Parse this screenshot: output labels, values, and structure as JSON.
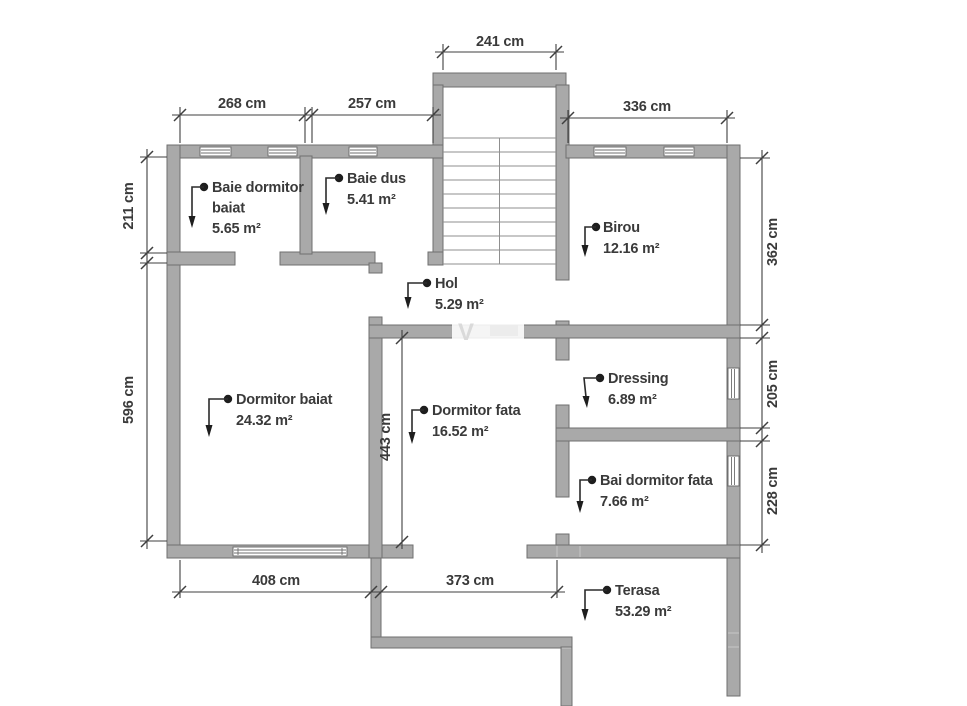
{
  "plan": {
    "watermark": "V",
    "rooms": [
      {
        "id": "baie-dormitor-baiat",
        "lines": [
          "Baie dormitor",
          "baiat",
          "5.65 m²"
        ]
      },
      {
        "id": "baie-dus",
        "lines": [
          "Baie dus",
          "5.41 m²"
        ]
      },
      {
        "id": "birou",
        "lines": [
          "Birou",
          "12.16 m²"
        ]
      },
      {
        "id": "hol",
        "lines": [
          "Hol",
          "5.29 m²"
        ]
      },
      {
        "id": "dormitor-baiat",
        "lines": [
          "Dormitor baiat",
          "24.32 m²"
        ]
      },
      {
        "id": "dormitor-fata",
        "lines": [
          "Dormitor fata",
          "16.52 m²"
        ]
      },
      {
        "id": "dressing",
        "lines": [
          "Dressing",
          "6.89 m²"
        ]
      },
      {
        "id": "bai-dormitor-fata",
        "lines": [
          "Bai dormitor fata",
          "7.66 m²"
        ]
      },
      {
        "id": "terasa",
        "lines": [
          "Terasa",
          "53.29 m²"
        ]
      }
    ],
    "dimensions": [
      {
        "id": "stairwell-width",
        "label": "241 cm"
      },
      {
        "id": "baie-dormitor-width",
        "label": "268 cm"
      },
      {
        "id": "baie-dus-width",
        "label": "257 cm"
      },
      {
        "id": "birou-width",
        "label": "336 cm"
      },
      {
        "id": "baie-height",
        "label": "211 cm"
      },
      {
        "id": "dormitor-baiat-height",
        "label": "596 cm"
      },
      {
        "id": "birou-height",
        "label": "362 cm"
      },
      {
        "id": "dressing-height",
        "label": "205 cm"
      },
      {
        "id": "bai-dormitor-fata-height",
        "label": "228 cm"
      },
      {
        "id": "dormitor-fata-height",
        "label": "443 cm"
      },
      {
        "id": "dormitor-baiat-width",
        "label": "408 cm"
      },
      {
        "id": "dormitor-fata-width",
        "label": "373 cm"
      }
    ],
    "colors": {
      "wall_fill": "#a9a9a9",
      "wall_stroke": "#6f6f6f",
      "text": "#3a3a3a",
      "dimension_line": "#3f3f3f",
      "stair_line": "#8f8f8f",
      "background": "#ffffff"
    }
  }
}
